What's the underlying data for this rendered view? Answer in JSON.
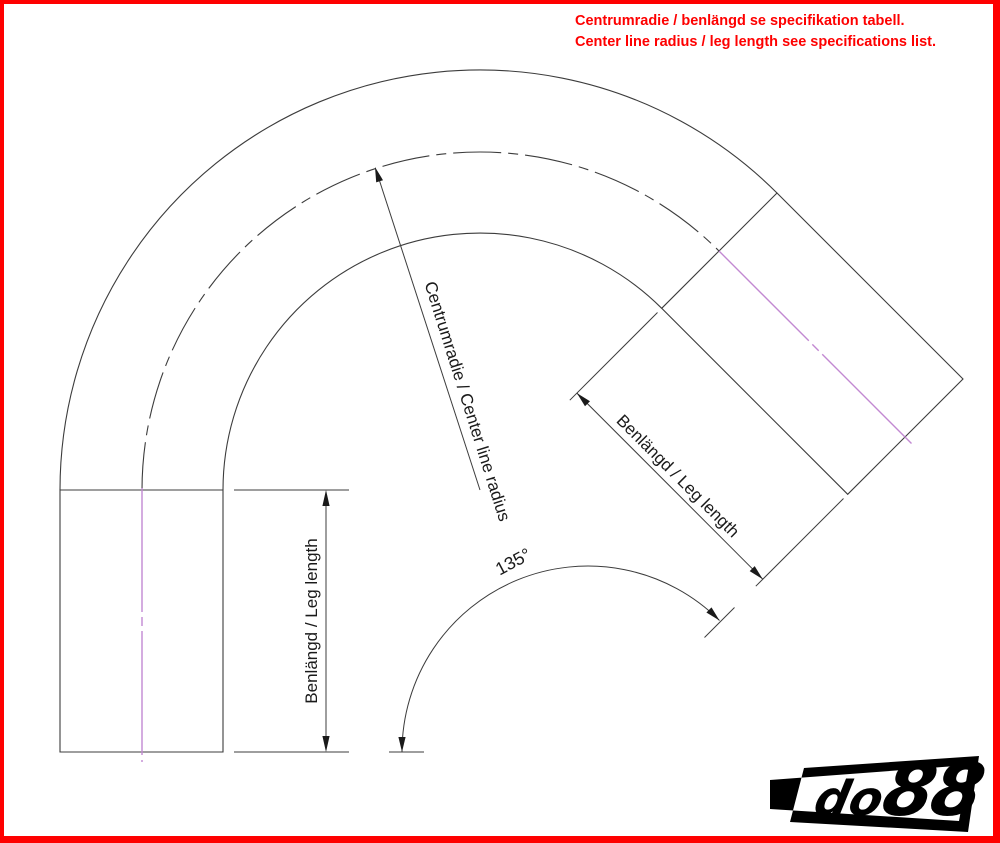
{
  "header": {
    "line1": "Centrumradie / benlängd se specifikation tabell.",
    "line2": "Center line radius / leg length see specifications list."
  },
  "drawing": {
    "radius_label": "Centrumradie / Center line radius",
    "angle_label": "135°",
    "left_leg_label": "Benlängd / Leg length",
    "right_leg_label": "Benlängd / Leg length",
    "bend_angle_deg": 135
  },
  "logo": {
    "prefix": "do",
    "suffix": "88"
  },
  "colors": {
    "accent_red": "#fe0000",
    "centerline_magenta": "#c289d2",
    "drawing_line": "#3c3c3c"
  }
}
